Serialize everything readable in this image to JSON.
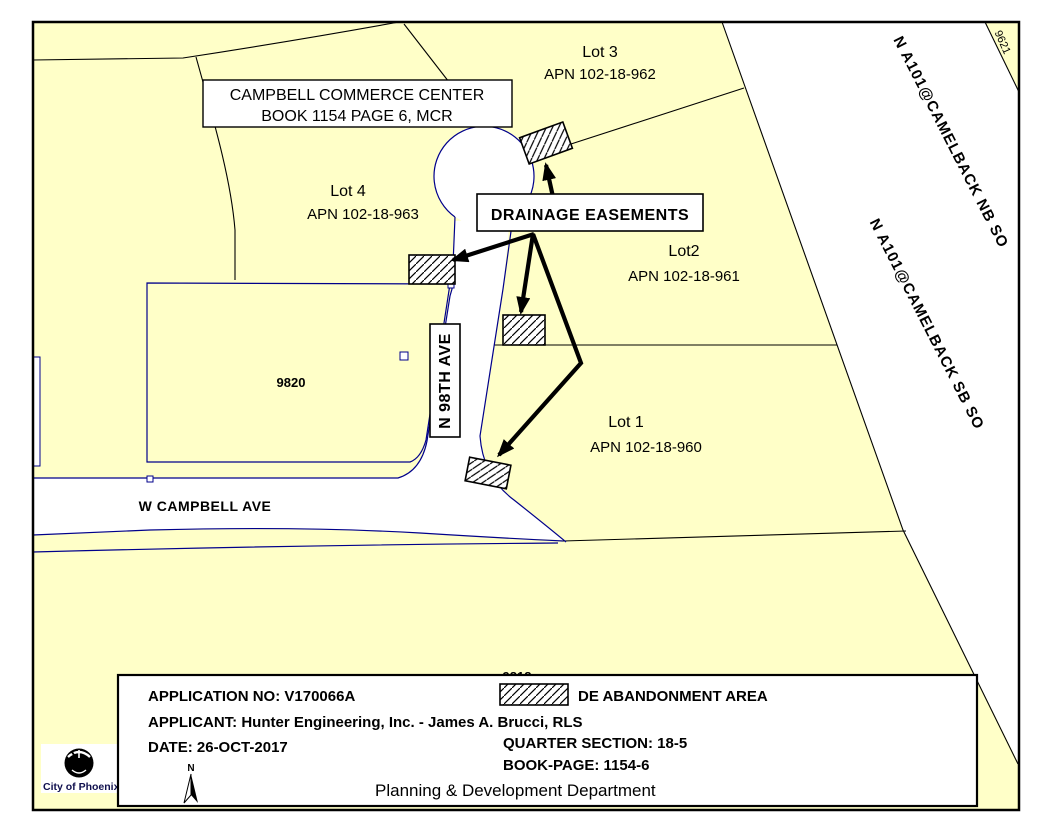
{
  "map": {
    "parcels": {
      "lot3": {
        "name": "Lot 3",
        "apn": "APN 102-18-962"
      },
      "lot4": {
        "name": "Lot 4",
        "apn": "APN 102-18-963"
      },
      "lot2": {
        "name": "Lot2",
        "apn": "APN 102-18-961"
      },
      "lot1": {
        "name": "Lot 1",
        "apn": "APN 102-18-960"
      }
    },
    "labels": {
      "commerce_center_line1": "CAMPBELL COMMERCE CENTER",
      "commerce_center_line2": "BOOK 1154 PAGE 6, MCR",
      "drainage": "DRAINAGE EASEMENTS"
    },
    "streets": {
      "campbell": "W CAMPBELL AVE",
      "ninety_eighth": "N 98TH AVE"
    },
    "freeway": {
      "nb": "N A101@CAMELBACK NB SO",
      "sb": "N A101@CAMELBACK SB SO"
    },
    "numbers": {
      "building": "9820",
      "corner_parcel": "9621",
      "clipped_building": "9818"
    }
  },
  "info_box": {
    "application": "APPLICATION NO: V170066A",
    "applicant": "APPLICANT:  Hunter Engineering, Inc. - James A. Brucci, RLS",
    "date": "DATE:  26-OCT-2017",
    "legend": "DE ABANDONMENT AREA",
    "quarter_section": "QUARTER SECTION:  18-5",
    "book_page": "BOOK-PAGE:  1154-6",
    "department": "Planning & Development Department",
    "north": "N"
  },
  "logo": {
    "text": "City of Phoenix"
  },
  "colors": {
    "parcel_fill": "#FFFFC8",
    "road_line": "#00008B",
    "boundary_line": "#000000",
    "page_background": "#FFFFFF",
    "hatch": "#000000"
  }
}
